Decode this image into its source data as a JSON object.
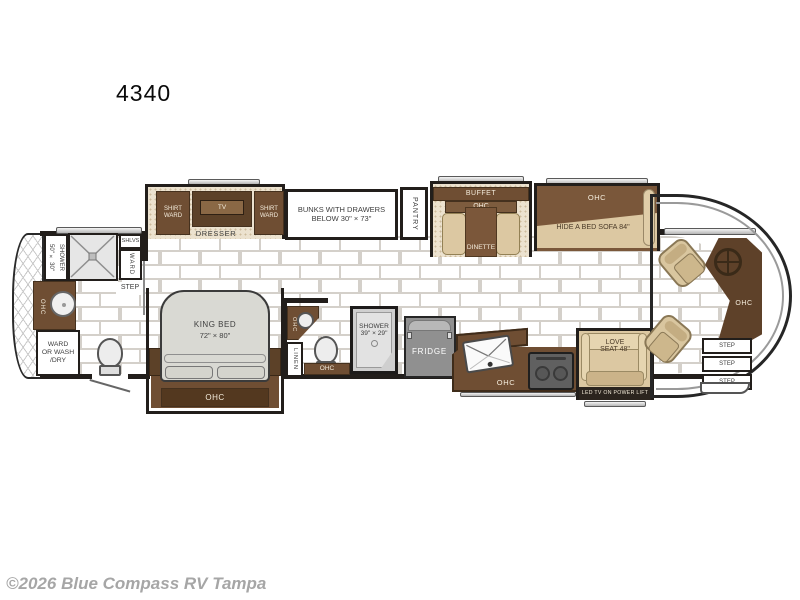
{
  "title": "4340",
  "watermark": "©2026 Blue Compass RV Tampa",
  "colors": {
    "wall": "#221e1b",
    "cabinet_brown": "#6F4E33",
    "dark_brown": "#53381F",
    "beige_furniture": "#DCC8A2",
    "appliance_gray": "#909090",
    "tile_grout": "#d4d0ca",
    "carpet": "#ece2cf",
    "watermark_gray": "#a6a6a6"
  },
  "labels": {
    "ohc": "OHC",
    "step": "STEP",
    "tv": "TV"
  },
  "bedroom": {
    "shirt_ward": "SHIRT\nWARD",
    "dresser": "DRESSER",
    "king_bed_line1": "KING BED",
    "king_bed_line2": "72\" × 80\""
  },
  "bunks": {
    "line1": "BUNKS WITH DRAWERS",
    "line2": "BELOW 30\" × 73\""
  },
  "pantry": "PANTRY",
  "rear_bath": {
    "shower_line1": "50\" × 30\"",
    "shower_line2": "SHOWER",
    "shlvs": "SHLVS",
    "ward": "WARD",
    "ward_or_wash_line1": "WARD",
    "ward_or_wash_line2": "OR WASH",
    "ward_or_wash_line3": "/DRY",
    "linen": "LINEN"
  },
  "mid_bath": {
    "shower_line1": "SHOWER",
    "shower_line2": "39\" × 29\""
  },
  "kitchen": {
    "fridge": "FRIDGE"
  },
  "living": {
    "buffet": "BUFFET",
    "dinette": "DINETTE",
    "sofa": "HIDE A BED SOFA 84\"",
    "love_seat_line1": "LOVE",
    "love_seat_line2": "SEAT 48\"",
    "led_tv": "LED TV ON POWER LIFT"
  }
}
